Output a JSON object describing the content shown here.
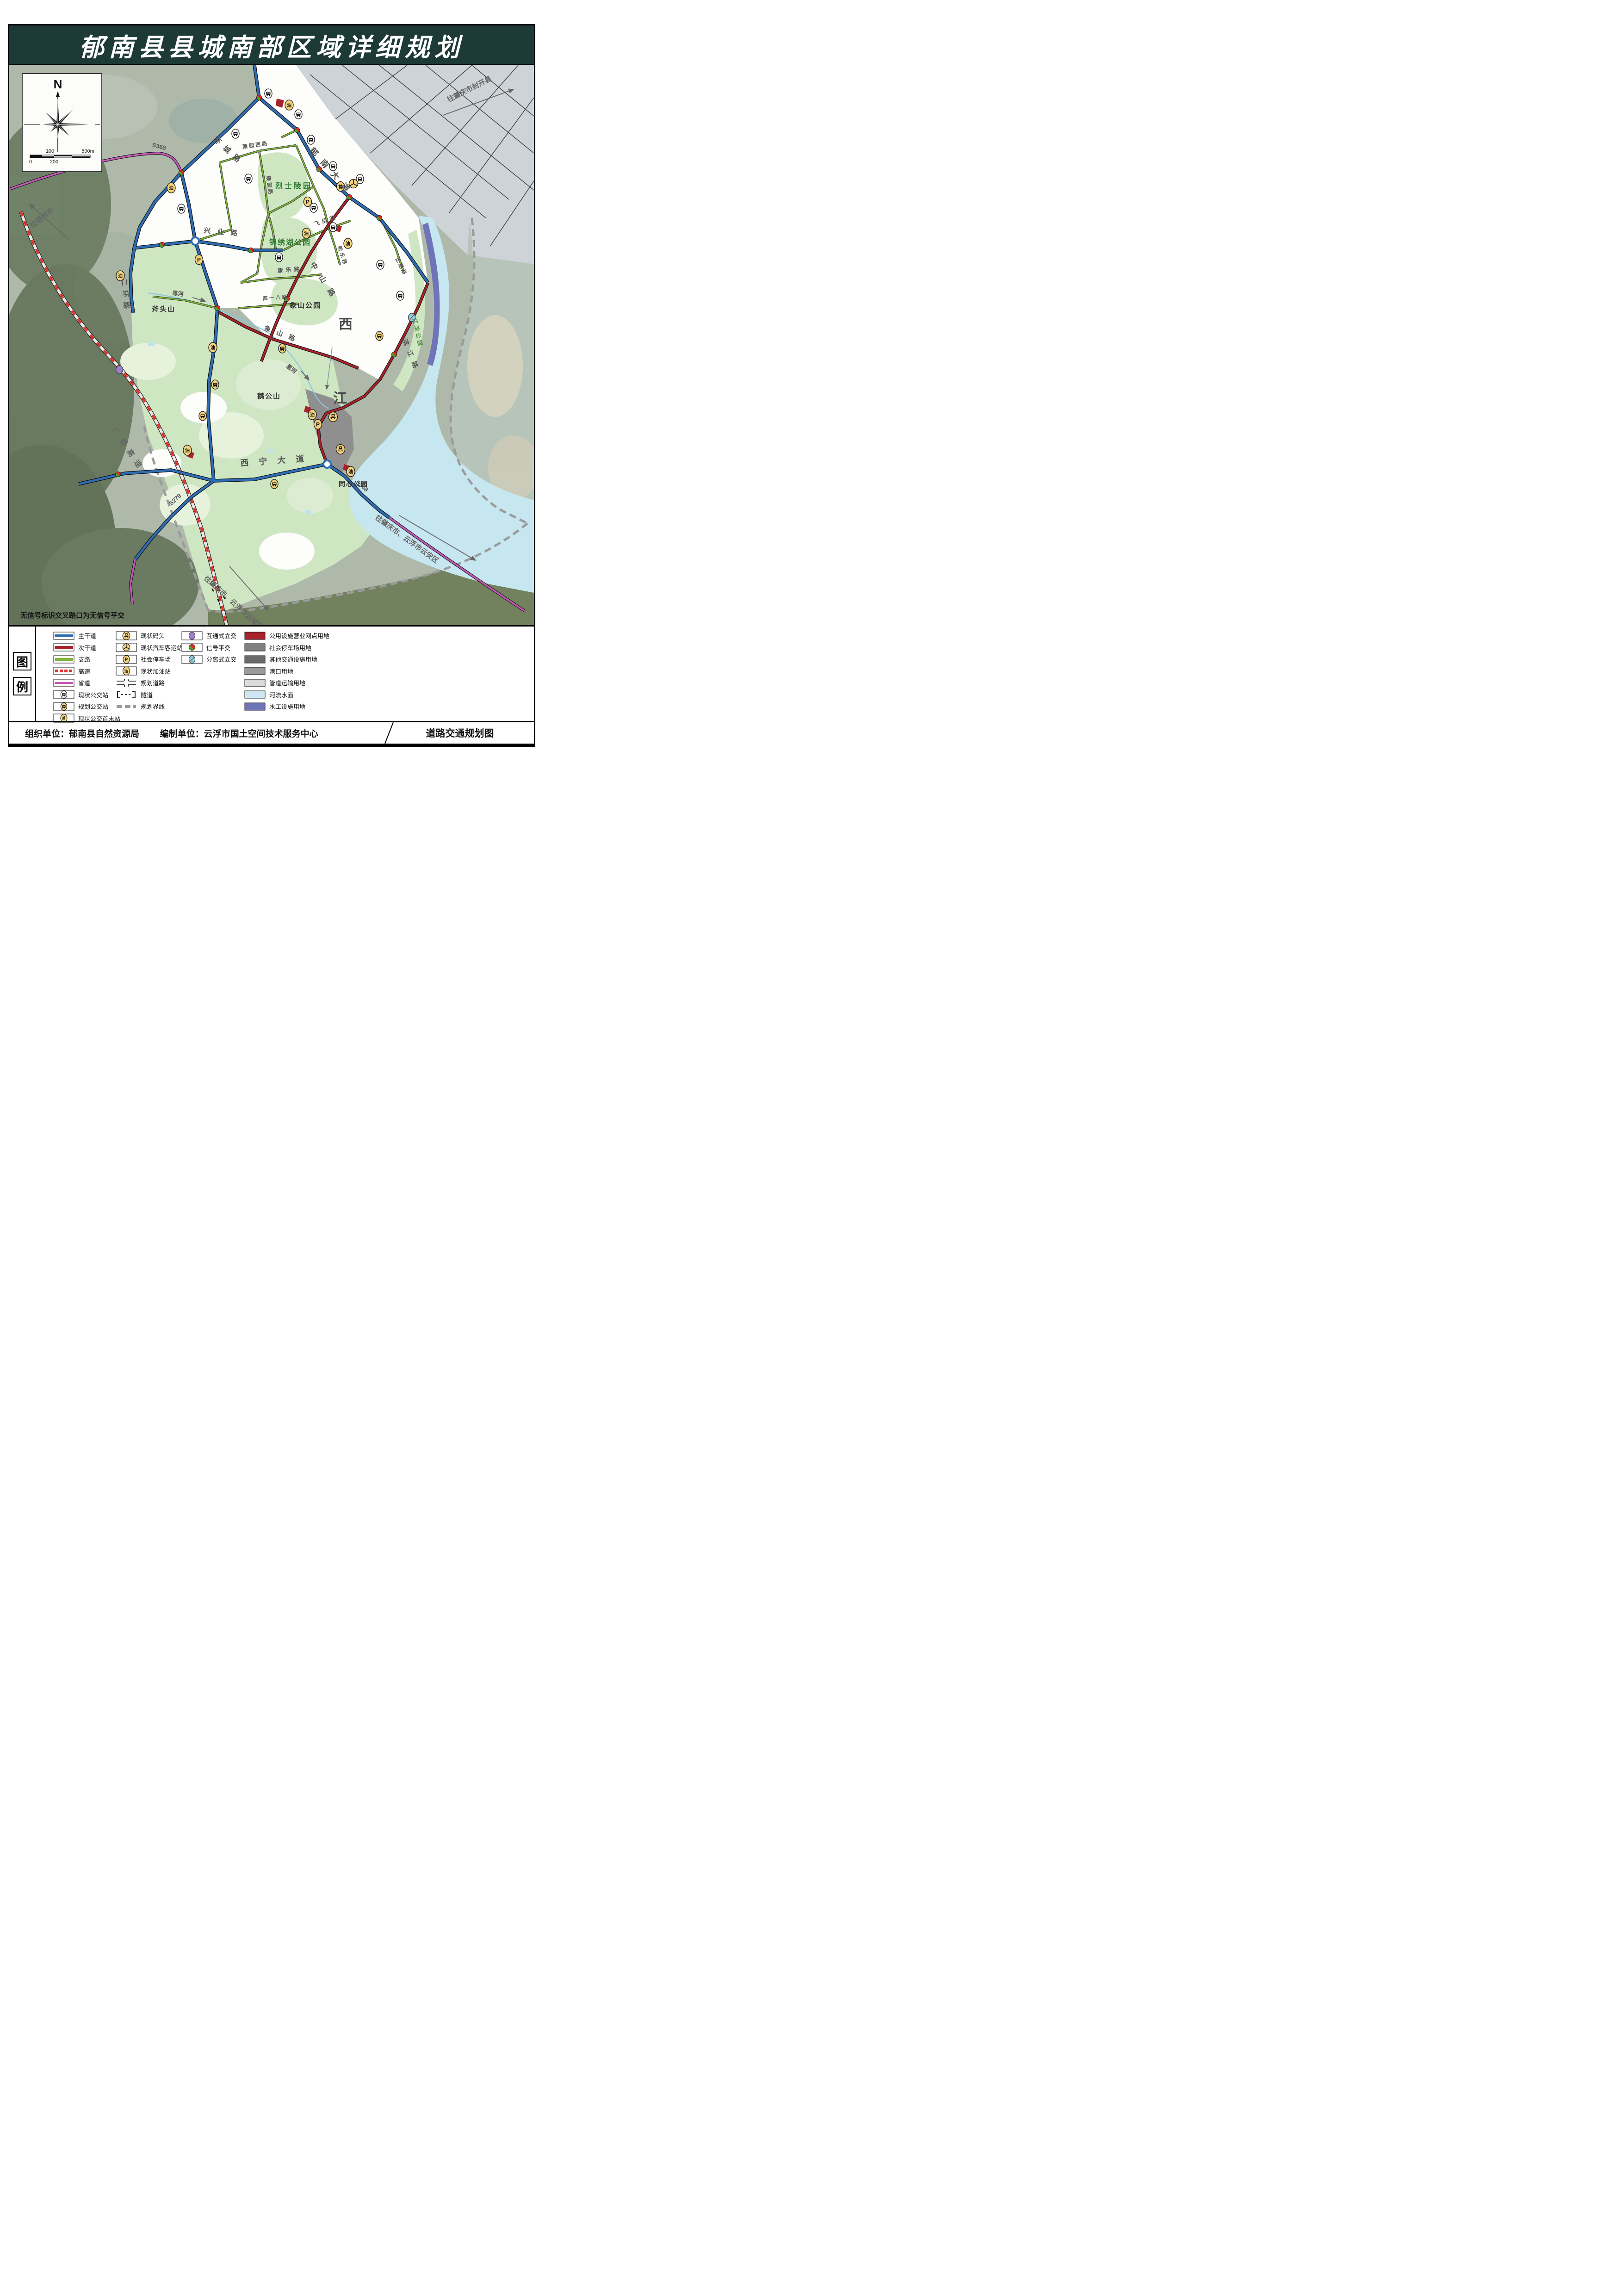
{
  "title": "郁南县县城南部区域详细规划",
  "note": "无信号标识交叉路口为无信号平交",
  "compass": {
    "n": "N",
    "ticks": [
      "0",
      "100",
      "200",
      "500m"
    ]
  },
  "footer": {
    "org_label": "组织单位：",
    "org": "郁南县自然资源局",
    "comp_label": "编制单位：",
    "comp": "云浮市国土空间技术服务中心",
    "map_name": "道路交通规划图"
  },
  "map": {
    "glyphs": {
      "gas": "油",
      "parking": "P",
      "terminus": "首"
    },
    "places": {
      "lieshi": "烈士陵园",
      "jinxiu": "锦绣湖公园",
      "xiangshan_park": "象山公园",
      "futou": "斧头山",
      "egong": "鹅公山",
      "tongxin": "同心公园",
      "jiangbin": "江滨公园",
      "xijiang_xi": "西",
      "xijiang_jiang": "江",
      "heihe": "黑河"
    },
    "roads": {
      "yunan": "郁南大道",
      "huancheng": "环城路",
      "erhuan": "二环路",
      "xingye": "兴业路",
      "zhongshan": "中山路",
      "xiangshan": "象山路",
      "xining": "西宁大道",
      "binjiang": "滨江路",
      "feifeng": "飞凤路",
      "kangle": "康乐路",
      "xinle": "新乐路",
      "lingyuanxi": "陵园西路",
      "lingyuan": "陵园路",
      "jiangdi": "江堤路",
      "sanyiba": "四一八路",
      "s368": "S368",
      "s279": "S279",
      "gaokun": "广昆高速"
    },
    "directions": {
      "wuzhou": "往梧州市",
      "fengkai": "往肇庆市封开县",
      "yunanqu": "往肇庆市、云浮市云安区",
      "yuncheng": "往肇庆市、云浮市云城区"
    }
  },
  "legend": {
    "heading_chars": [
      "图",
      "例"
    ],
    "roads": [
      {
        "label": "主干道",
        "color": "#2e6db4"
      },
      {
        "label": "次干道",
        "color": "#a8232b"
      },
      {
        "label": "支路",
        "color": "#7fb23d"
      },
      {
        "label": "高速",
        "color": "#e03127"
      },
      {
        "label": "省道",
        "color": "#c25ab5"
      },
      {
        "label": "现状公交站"
      },
      {
        "label": "规划公交站"
      },
      {
        "label": "现状公交首末站"
      }
    ],
    "facilities": [
      {
        "label": "现状码头"
      },
      {
        "label": "现状汽车客运站"
      },
      {
        "label": "社会停车场"
      },
      {
        "label": "现状加油站"
      },
      {
        "label": "规划道路"
      },
      {
        "label": "隧道"
      },
      {
        "label": "规划界线",
        "color": "#9b9b9b"
      }
    ],
    "junctions": [
      {
        "label": "互通式立交",
        "color": "#9e7fc9"
      },
      {
        "label": "信号平交",
        "color_a": "#d92b1f",
        "color_b": "#4aa321"
      },
      {
        "label": "分离式立交",
        "color": "#7fd4e4"
      }
    ],
    "landuse": [
      {
        "label": "公用设施营业网点用地",
        "color": "#a8232b"
      },
      {
        "label": "社会停车场用地",
        "color": "#808080"
      },
      {
        "label": "其他交通设施用地",
        "color": "#6a6a6a"
      },
      {
        "label": "港口用地",
        "color": "#9b9b9b"
      },
      {
        "label": "管道运输用地",
        "color": "#dcdcdc"
      },
      {
        "label": "河流水面",
        "color": "#cde8f2"
      },
      {
        "label": "水工设施用地",
        "color": "#6f74b8"
      }
    ]
  }
}
